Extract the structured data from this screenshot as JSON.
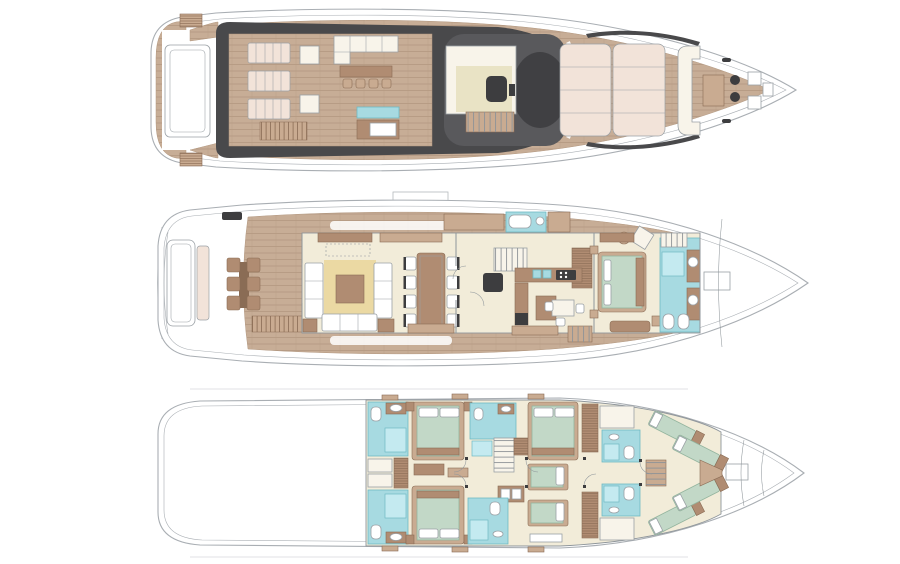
{
  "canvas": {
    "width": 900,
    "height": 564
  },
  "figure": {
    "type": "yacht-deck-plans",
    "deck_count": 3
  },
  "decks": [
    {
      "id": "sun-deck"
    },
    {
      "id": "main-deck"
    },
    {
      "id": "lower-deck"
    }
  ],
  "palette": {
    "hull_line": "#a9aeb3",
    "wall": "#8f969b",
    "outline": "#9aa0a5",
    "teak": "#c7ad96",
    "teak_line": "#b2977f",
    "charcoal": "#49494b",
    "charcoal_glass": "#59595c",
    "charcoal_deep": "#404043",
    "cream_floor": "#f2ecd9",
    "cream_pad": "#f8f4ea",
    "blush": "#f2e3d9",
    "khaki": "#e9e3c5",
    "rug": "#ebd9a3",
    "brown": "#b08c72",
    "brown_light": "#c9ab91",
    "brown_dark": "#8a6c55",
    "aqua": "#a7dae1",
    "aqua_dark": "#6fb9c4",
    "aqua_pale": "#c4eaf0",
    "sage": "#c2d8c7",
    "sage_dark": "#93b49e",
    "dark_fixture": "#3d3d3f",
    "white": "#ffffff"
  }
}
